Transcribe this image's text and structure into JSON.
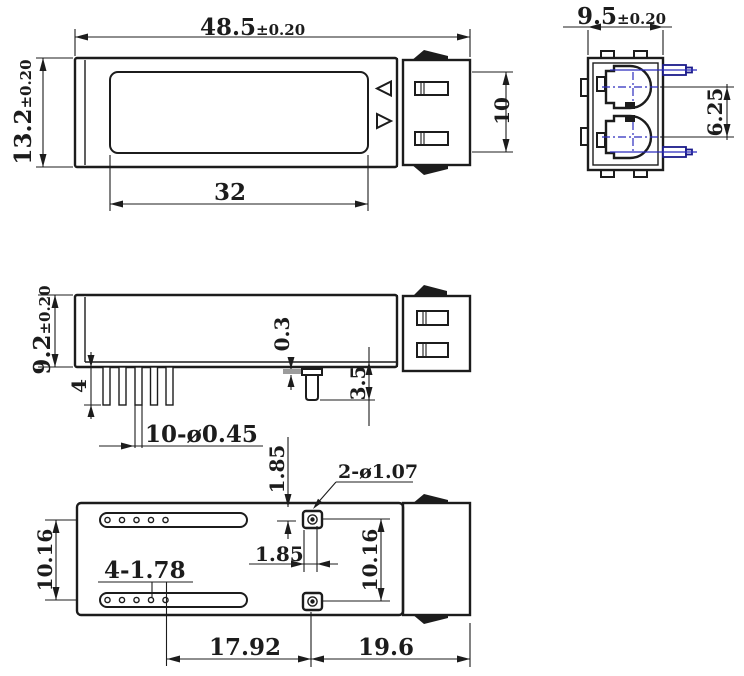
{
  "colors": {
    "line": "#1c1c1c",
    "centerline_blue": "#2b2bbd",
    "boss_gray": "#9c9c9c",
    "background": "#ffffff"
  },
  "icons": {
    "label_arrow_left": "◁",
    "label_arrow_right": "▷"
  },
  "top_view": {
    "length_value": "48.5",
    "length_tol": "±0.20",
    "height_value": "13.2",
    "height_tol": "±0.20",
    "label_window_length": "32",
    "connector_slot_height": "10"
  },
  "end_view": {
    "width_value": "9.5",
    "width_tol": "±0.20",
    "port_pitch": "6.25"
  },
  "side_view": {
    "height_value": "9.2",
    "height_tol": "±0.20",
    "pin_length": "4",
    "pin_callout": "10-ø0.45",
    "boss_height": "0.3",
    "peg_height": "3.5"
  },
  "bottom_view": {
    "slot_pitch": "10.16",
    "hole_callout": "4-1.78",
    "peg_offset_vertical": "1.85",
    "peg_offset_horizontal": "1.85",
    "peg_pitch": "10.16",
    "holes_to_peg": "17.92",
    "peg_to_edge": "19.6",
    "peg_callout": "2-ø1.07"
  }
}
